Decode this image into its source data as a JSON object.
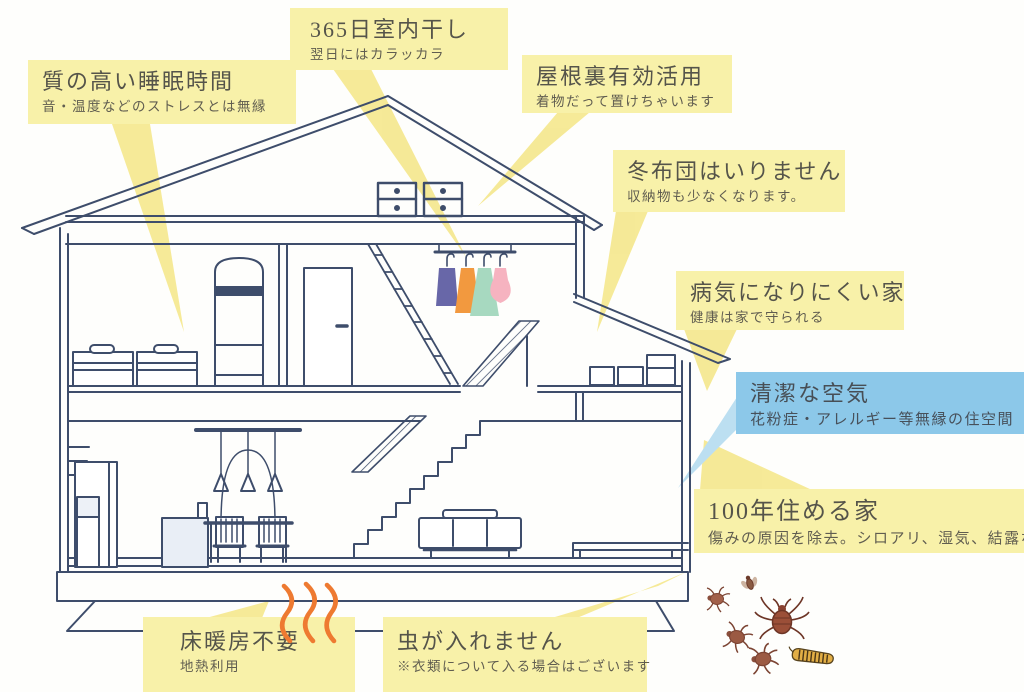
{
  "callouts": [
    {
      "id": "quality-sleep",
      "title": "質の高い睡眠時間",
      "subtitle": "音・温度などのストレスとは無縁",
      "color": "yellow"
    },
    {
      "id": "indoor-drying",
      "title": "365日室内干し",
      "subtitle": "翌日にはカラッカラ",
      "color": "yellow"
    },
    {
      "id": "attic-use",
      "title": "屋根裏有効活用",
      "subtitle": "着物だって置けちゃいます",
      "color": "yellow"
    },
    {
      "id": "no-winter-futon",
      "title": "冬布団はいりません",
      "subtitle": "収納物も少なくなります。",
      "color": "yellow"
    },
    {
      "id": "healthy-house",
      "title": "病気になりにくい家",
      "subtitle": "健康は家で守られる",
      "color": "yellow"
    },
    {
      "id": "clean-air",
      "title": "清潔な空気",
      "subtitle": "花粉症・アレルギー等無縁の住空間",
      "color": "blue"
    },
    {
      "id": "100-year-house",
      "title": "100年住める家",
      "subtitle": "傷みの原因を除去。シロアリ、湿気、結露など",
      "color": "yellow"
    },
    {
      "id": "no-floor-heating",
      "title": "床暖房不要",
      "subtitle": "地熱利用",
      "color": "yellow"
    },
    {
      "id": "no-insects",
      "title": "虫が入れません",
      "subtitle": "※衣類について入る場合はございます",
      "color": "yellow"
    }
  ],
  "colors": {
    "callout_yellow": "#f8f1a9",
    "callout_blue": "#8cc8e9",
    "pointer_beam_yellow": "#f5e88f",
    "pointer_beam_blue": "#b7ddf1",
    "line_ink": "#3e4d6b",
    "heat_wave_orange": "#ee7a31",
    "bug_brown": "#9b5a43",
    "clothes_purple": "#6867a8",
    "clothes_orange": "#f2993f",
    "clothes_mint": "#a7d9c0",
    "clothes_pink": "#f6b3c0"
  },
  "icons": {
    "heat_waves": "heat-wave-icon",
    "bugs": [
      "fly-icon",
      "mite-icon",
      "big-mite-icon",
      "tick-icon",
      "caterpillar-icon"
    ]
  }
}
